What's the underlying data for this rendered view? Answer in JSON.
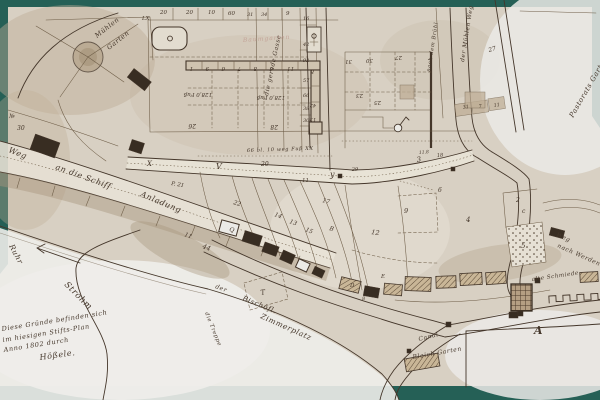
{
  "colors": {
    "frame": "#256056",
    "paper": "#d8d0c3",
    "paper_light": "#ebeae6",
    "tan": "#bfae96",
    "shade": "#a8977e",
    "ink": "#44362a",
    "ink_light": "#6d5c46",
    "faded_red": "#bd948a",
    "building": "#382d22",
    "road_fill": "#e9e3d7"
  },
  "map": {
    "inscription": {
      "lines": [
        "Diese Gründe befinden sich",
        "im hiesigen Stifts-Plan",
        "Anno 1802 durch"
      ],
      "signature": "Hößele."
    },
    "features": [
      "rondel-well",
      "fountain-basin",
      "gate-monument",
      "flag-circle-marker",
      "flow-direction-arrow",
      "crenellated-wall",
      "mill-building",
      "quay-marker",
      "bleachfield-building"
    ],
    "labels": [
      [
        "20",
        160,
        14,
        0,
        5.5,
        "n"
      ],
      [
        "20",
        186,
        14,
        0,
        5.5,
        "n"
      ],
      [
        "10",
        208,
        14,
        0,
        5.5,
        "n"
      ],
      [
        "60",
        228,
        15,
        0,
        5.5,
        "n"
      ],
      [
        "31",
        247,
        16,
        0,
        5,
        "n"
      ],
      [
        "34",
        261,
        16,
        0,
        5,
        "n"
      ],
      [
        "9",
        286,
        15,
        0,
        5.5,
        "n"
      ],
      [
        "LX",
        142,
        20,
        0,
        5.5,
        "n"
      ],
      [
        "16",
        303,
        20,
        0,
        5,
        "n"
      ],
      [
        "42",
        303,
        46,
        0,
        5,
        "n"
      ],
      [
        "92",
        303,
        62,
        0,
        5,
        "n"
      ],
      [
        "57",
        303,
        82,
        0,
        5,
        "n"
      ],
      [
        "66",
        303,
        97,
        0,
        5,
        "n"
      ],
      [
        "38",
        303,
        110,
        0,
        5,
        "n"
      ],
      [
        "30",
        303,
        122,
        0,
        5,
        "n"
      ],
      [
        "№",
        9,
        118,
        0,
        6,
        "n"
      ],
      [
        "30",
        17,
        130,
        0,
        6,
        "n"
      ],
      [
        "Mühlen",
        97,
        38,
        -38,
        6.5,
        "c"
      ],
      [
        "Garten",
        109,
        50,
        -38,
        6.5,
        "c"
      ],
      [
        "die gerade Gasse",
        268,
        96,
        -78,
        6,
        "c"
      ],
      [
        "Baumgarten",
        243,
        42,
        -4,
        6,
        "f"
      ],
      [
        "1",
        193,
        67,
        180,
        5.5,
        "n"
      ],
      [
        "9",
        209,
        67,
        180,
        5.5,
        "n"
      ],
      [
        "6",
        225,
        67,
        180,
        5.5,
        "n"
      ],
      [
        "7",
        241,
        67,
        180,
        5.5,
        "n"
      ],
      [
        "8",
        257,
        67,
        180,
        5.5,
        "n"
      ],
      [
        "6",
        273,
        67,
        180,
        5.5,
        "n"
      ],
      [
        "11",
        294,
        67,
        180,
        5.5,
        "n"
      ],
      [
        "8",
        314,
        70,
        180,
        5.5,
        "n"
      ],
      [
        "128,0 Fuß",
        212,
        93,
        180,
        5.5,
        "n"
      ],
      [
        "128,0 Fuß",
        285,
        96,
        180,
        5.5,
        "n"
      ],
      [
        "26",
        196,
        124,
        180,
        6,
        "n"
      ],
      [
        "28",
        278,
        125,
        180,
        6,
        "n"
      ],
      [
        "42",
        316,
        104,
        180,
        5,
        "n"
      ],
      [
        "13",
        316,
        118,
        180,
        5,
        "n"
      ],
      [
        "31",
        352,
        60,
        180,
        5.5,
        "n"
      ],
      [
        "30",
        373,
        59,
        180,
        5.5,
        "n"
      ],
      [
        "27",
        402,
        56,
        180,
        5.5,
        "n"
      ],
      [
        "23",
        363,
        94,
        180,
        5.5,
        "n"
      ],
      [
        "25",
        381,
        101,
        180,
        5.5,
        "n"
      ],
      [
        "27",
        489,
        52,
        -15,
        6,
        "n"
      ],
      [
        "31",
        463,
        109,
        -10,
        4.8,
        "n"
      ],
      [
        "7",
        479,
        108,
        -10,
        4.8,
        "n"
      ],
      [
        "11",
        494,
        107,
        -10,
        4.8,
        "n"
      ],
      [
        "der Mühlen Weg",
        464,
        62,
        -81,
        5.8,
        "c"
      ],
      [
        "nach dem Brühl",
        430,
        72,
        -81,
        5.2,
        "c"
      ],
      [
        "Pastorats Garten",
        573,
        118,
        -60,
        7,
        "c"
      ],
      [
        "66 bl. 10 weg Fuß XX",
        247,
        152,
        -2,
        5,
        "c"
      ],
      [
        "V",
        216,
        169,
        0,
        8,
        "c"
      ],
      [
        "20",
        261,
        166,
        0,
        6,
        "n"
      ],
      [
        "y",
        330,
        177,
        0,
        8,
        "c"
      ],
      [
        "11",
        302,
        182,
        0,
        5.5,
        "n"
      ],
      [
        "X",
        147,
        166,
        0,
        7,
        "c"
      ],
      [
        "P. 21",
        171,
        185,
        10,
        5.5,
        "n"
      ],
      [
        "29",
        352,
        171,
        -3,
        5,
        "n"
      ],
      [
        "18",
        437,
        157,
        -5,
        5,
        "n"
      ],
      [
        "11.8",
        419,
        154,
        -5,
        4.5,
        "n"
      ],
      [
        "22",
        233,
        204,
        18,
        6,
        "n"
      ],
      [
        "17",
        322,
        202,
        15,
        6,
        "n"
      ],
      [
        "14",
        274,
        216,
        20,
        6,
        "n"
      ],
      [
        "13",
        289,
        223,
        20,
        6,
        "n"
      ],
      [
        "15",
        305,
        231,
        22,
        6,
        "n"
      ],
      [
        "B",
        329,
        230,
        15,
        6,
        "c"
      ],
      [
        "12",
        371,
        234,
        8,
        6.5,
        "n"
      ],
      [
        "Q",
        229,
        231,
        15,
        6,
        "c"
      ],
      [
        "44",
        202,
        248,
        20,
        6.5,
        "n"
      ],
      [
        "11",
        184,
        236,
        20,
        6,
        "n"
      ],
      [
        "D",
        350,
        287,
        0,
        5.5,
        "c"
      ],
      [
        "E",
        381,
        278,
        0,
        5.5,
        "c"
      ],
      [
        "8",
        362,
        300,
        0,
        5,
        "n"
      ],
      [
        "T",
        261,
        295,
        -10,
        7,
        "c"
      ],
      [
        "3",
        417,
        162,
        -8,
        7,
        "n"
      ],
      [
        "9",
        404,
        213,
        0,
        6.5,
        "n"
      ],
      [
        "6",
        438,
        192,
        0,
        6,
        "n"
      ],
      [
        "4",
        466,
        222,
        0,
        7,
        "n"
      ],
      [
        "2",
        516,
        202,
        0,
        6,
        "n"
      ],
      [
        "c",
        522,
        213,
        0,
        6,
        "c"
      ],
      [
        "5",
        521,
        248,
        0,
        7,
        "n"
      ],
      [
        "Weg",
        8,
        152,
        22,
        8,
        "c"
      ],
      [
        "an die Schiff",
        55,
        169,
        20,
        8,
        "c"
      ],
      [
        "Anladung",
        140,
        196,
        23,
        8,
        "c"
      ],
      [
        "Ruhr",
        9,
        246,
        62,
        7.5,
        "c"
      ],
      [
        "Strohm",
        64,
        285,
        45,
        8.5,
        "c"
      ],
      [
        "der",
        215,
        288,
        20,
        6,
        "c"
      ],
      [
        "Bischöfl.",
        242,
        300,
        22,
        7,
        "c"
      ],
      [
        "Zimmerplatz",
        260,
        318,
        24,
        7.5,
        "c"
      ],
      [
        "die Treppe",
        205,
        313,
        68,
        5.5,
        "c"
      ],
      [
        "Canal",
        419,
        341,
        -14,
        6,
        "c"
      ],
      [
        "Bleich Garten",
        413,
        359,
        -10,
        6,
        "c"
      ],
      [
        "Weg",
        556,
        236,
        24,
        6,
        "c"
      ],
      [
        "nach Werden",
        557,
        247,
        24,
        6,
        "c"
      ],
      [
        "alte Schmiede",
        532,
        281,
        -8,
        5.5,
        "c"
      ],
      [
        "A",
        534,
        334,
        0,
        11,
        "b"
      ]
    ]
  }
}
